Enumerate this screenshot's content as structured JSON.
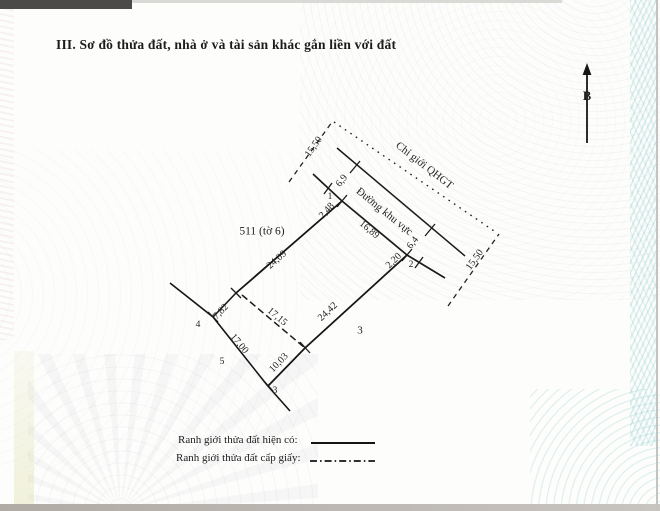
{
  "title": "III. Sơ đồ thửa đất, nhà ở và tài sản khác gắn liền với đất",
  "compass": {
    "north_label": "B"
  },
  "diagram": {
    "parcel_id": "511 (tờ 6)",
    "road_name": "Đường khu vực",
    "planning_boundary": "Chỉ giới QHGT",
    "lot_number": "3",
    "vertices": {
      "v1": "1",
      "v2": "2",
      "v3": "3",
      "v4": "4",
      "v5": "5"
    },
    "dimensions": {
      "qhgt_width_top": "15,50",
      "road_width_top": "6,9",
      "corner1_offset": "2,48",
      "front_edge": "16,89",
      "road_width_bottom": "6,4",
      "corner2_offset": "2,20",
      "qhgt_width_bottom": "15,50",
      "left_edge": "24,09",
      "right_edge": "24,42",
      "inner_dashed_edge": "17,15",
      "rear_short_edge": "7,82",
      "outer_edge": "17,00",
      "bottom_edge": "10,03"
    }
  },
  "legend": {
    "existing_boundary_label": "Ranh giới thửa đất hiện có:",
    "granted_boundary_label": "Ranh giới thửa đất cấp giấy:"
  },
  "colors": {
    "ink": "#1c1c1c",
    "paper": "#fdfdfc"
  }
}
